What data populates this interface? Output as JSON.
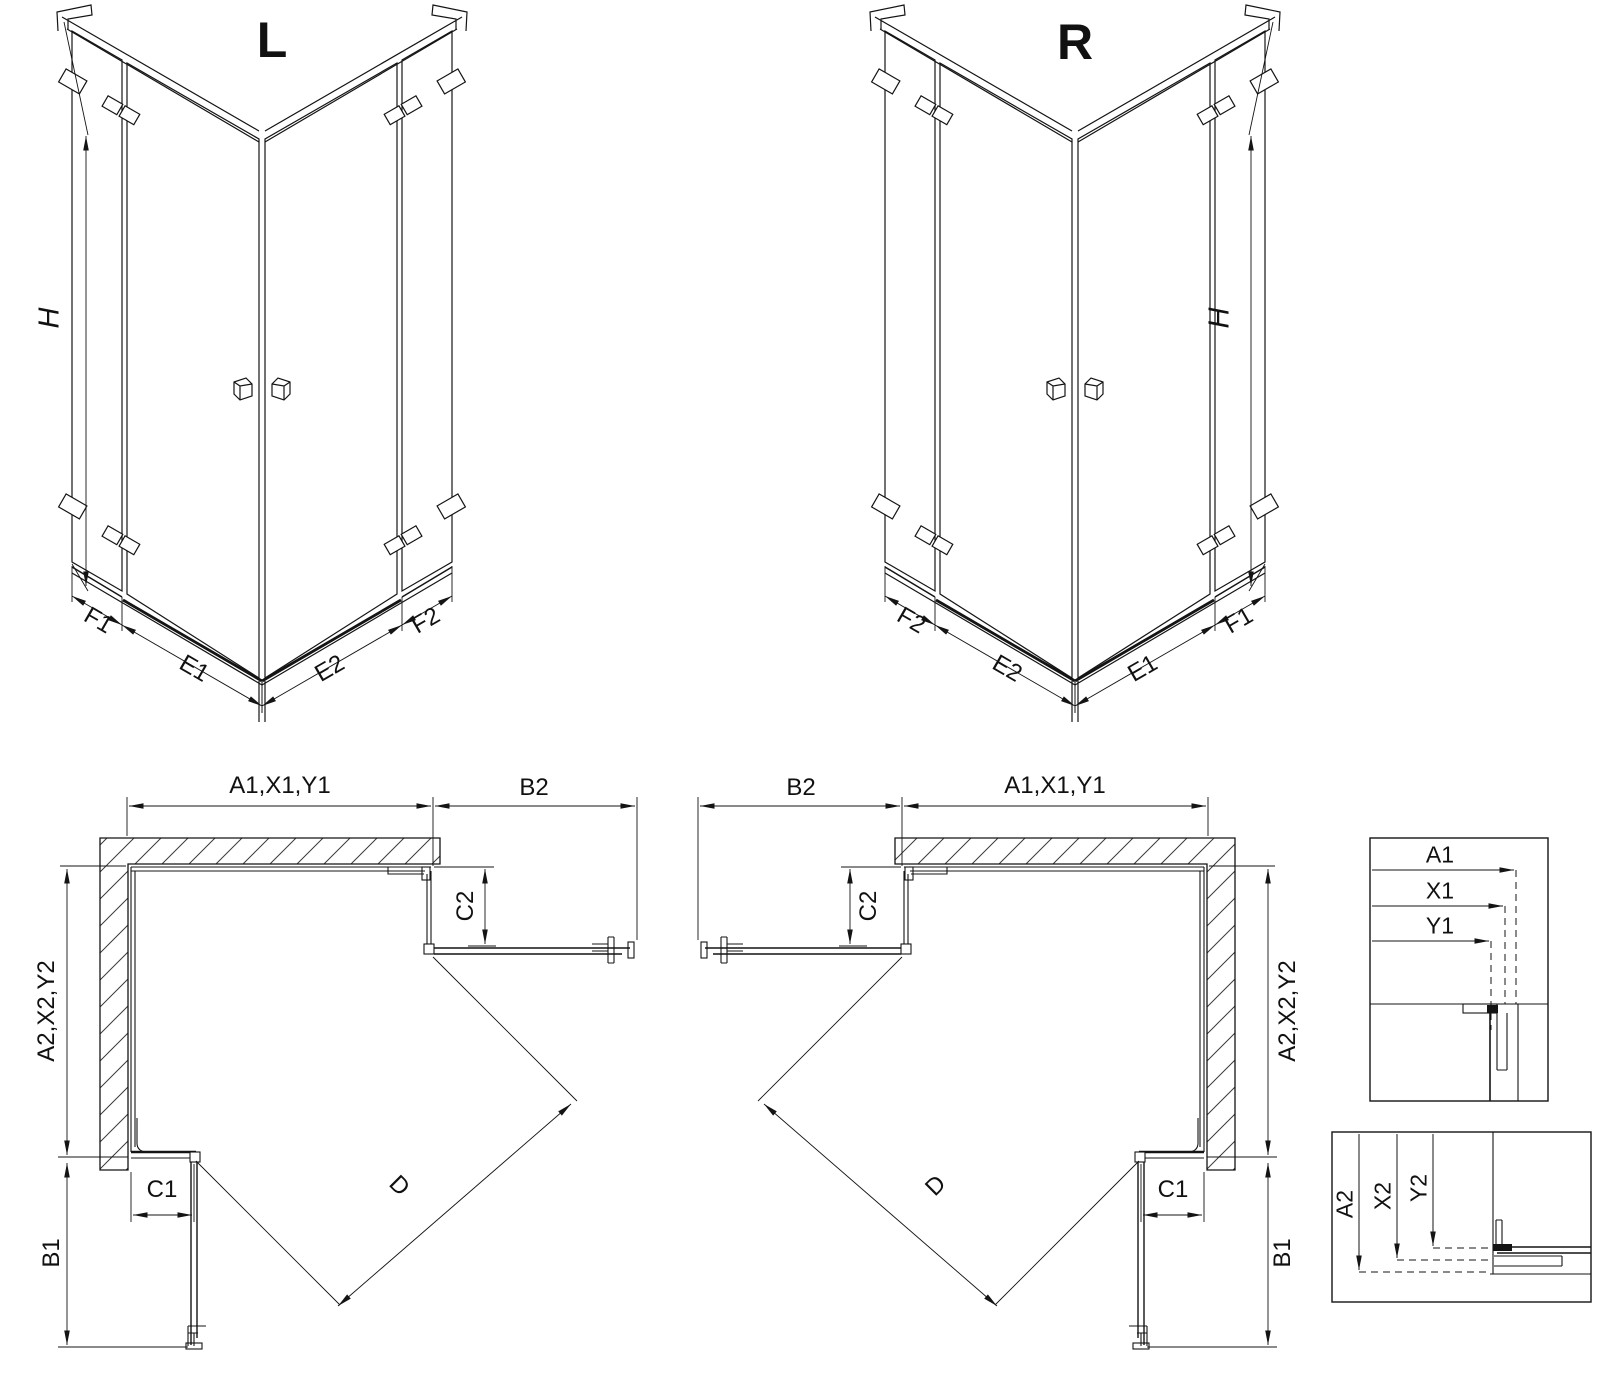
{
  "drawing": {
    "type": "technical-diagram",
    "subject": "corner shower enclosure installation dimensions",
    "variants": [
      "L",
      "R"
    ],
    "line_color": "#141414",
    "background": "#ffffff"
  },
  "labels": [
    {
      "name": "iso-l-title",
      "text": "L",
      "x": 272,
      "y": 40,
      "rot": 0,
      "cls": "t-title"
    },
    {
      "name": "iso-l-dim-h",
      "text": "H",
      "x": 50,
      "y": 318,
      "rot": -90,
      "cls": "t-h"
    },
    {
      "name": "iso-l-dim-f1",
      "text": "F1",
      "x": 98,
      "y": 621,
      "rot": 30,
      "cls": "t-dim"
    },
    {
      "name": "iso-l-dim-e1",
      "text": "E1",
      "x": 194,
      "y": 669,
      "rot": 30,
      "cls": "t-dim"
    },
    {
      "name": "iso-l-dim-e2",
      "text": "E2",
      "x": 330,
      "y": 669,
      "rot": -30,
      "cls": "t-dim"
    },
    {
      "name": "iso-l-dim-f2",
      "text": "F2",
      "x": 426,
      "y": 621,
      "rot": -30,
      "cls": "t-dim"
    },
    {
      "name": "iso-r-title",
      "text": "R",
      "x": 1075,
      "y": 42,
      "rot": 0,
      "cls": "t-title"
    },
    {
      "name": "iso-r-dim-h",
      "text": "H",
      "x": 1220,
      "y": 318,
      "rot": -90,
      "cls": "t-h"
    },
    {
      "name": "iso-r-dim-f2",
      "text": "F2",
      "x": 911,
      "y": 621,
      "rot": 30,
      "cls": "t-dim"
    },
    {
      "name": "iso-r-dim-e2",
      "text": "E2",
      "x": 1007,
      "y": 669,
      "rot": 30,
      "cls": "t-dim"
    },
    {
      "name": "iso-r-dim-e1",
      "text": "E1",
      "x": 1143,
      "y": 669,
      "rot": -30,
      "cls": "t-dim"
    },
    {
      "name": "iso-r-dim-f1",
      "text": "F1",
      "x": 1239,
      "y": 621,
      "rot": -30,
      "cls": "t-dim"
    },
    {
      "name": "plan-l-dim-a1x1y1",
      "text": "A1,X1,Y1",
      "x": 280,
      "y": 786,
      "rot": 0,
      "cls": "t-dim"
    },
    {
      "name": "plan-l-dim-b2",
      "text": "B2",
      "x": 534,
      "y": 788,
      "rot": 0,
      "cls": "t-dim"
    },
    {
      "name": "plan-l-dim-c2",
      "text": "C2",
      "x": 466,
      "y": 906,
      "rot": -90,
      "cls": "t-dim"
    },
    {
      "name": "plan-l-dim-a2x2y2",
      "text": "A2,X2,Y2",
      "x": 47,
      "y": 1011,
      "rot": -90,
      "cls": "t-dim"
    },
    {
      "name": "plan-l-dim-c1",
      "text": "C1",
      "x": 162,
      "y": 1190,
      "rot": 0,
      "cls": "t-dim"
    },
    {
      "name": "plan-l-dim-b1",
      "text": "B1",
      "x": 52,
      "y": 1253,
      "rot": -90,
      "cls": "t-dim"
    },
    {
      "name": "plan-l-dim-d",
      "text": "D",
      "x": 399,
      "y": 1186,
      "rot": 45,
      "cls": "t-dim"
    },
    {
      "name": "plan-r-dim-b2",
      "text": "B2",
      "x": 801,
      "y": 788,
      "rot": 0,
      "cls": "t-dim"
    },
    {
      "name": "plan-r-dim-a1x1y1",
      "text": "A1,X1,Y1",
      "x": 1055,
      "y": 786,
      "rot": 0,
      "cls": "t-dim"
    },
    {
      "name": "plan-r-dim-c2",
      "text": "C2",
      "x": 869,
      "y": 906,
      "rot": -90,
      "cls": "t-dim"
    },
    {
      "name": "plan-r-dim-a2x2y2",
      "text": "A2,X2,Y2",
      "x": 1288,
      "y": 1011,
      "rot": -90,
      "cls": "t-dim"
    },
    {
      "name": "plan-r-dim-c1",
      "text": "C1",
      "x": 1173,
      "y": 1190,
      "rot": 0,
      "cls": "t-dim"
    },
    {
      "name": "plan-r-dim-b1",
      "text": "B1",
      "x": 1283,
      "y": 1253,
      "rot": -90,
      "cls": "t-dim"
    },
    {
      "name": "plan-r-dim-d",
      "text": "D",
      "x": 936,
      "y": 1186,
      "rot": -45,
      "cls": "t-dim"
    },
    {
      "name": "detail-top-dim-a1",
      "text": "A1",
      "x": 1440,
      "y": 855,
      "rot": 0,
      "cls": "t-dims"
    },
    {
      "name": "detail-top-dim-x1",
      "text": "X1",
      "x": 1440,
      "y": 891,
      "rot": 0,
      "cls": "t-dims"
    },
    {
      "name": "detail-top-dim-y1",
      "text": "Y1",
      "x": 1440,
      "y": 926,
      "rot": 0,
      "cls": "t-dims"
    },
    {
      "name": "detail-bottom-dim-a2",
      "text": "A2",
      "x": 1345,
      "y": 1204,
      "rot": -90,
      "cls": "t-dims"
    },
    {
      "name": "detail-bottom-dim-x2",
      "text": "X2",
      "x": 1383,
      "y": 1196,
      "rot": -90,
      "cls": "t-dims"
    },
    {
      "name": "detail-bottom-dim-y2",
      "text": "Y2",
      "x": 1419,
      "y": 1188,
      "rot": -90,
      "cls": "t-dims"
    }
  ]
}
